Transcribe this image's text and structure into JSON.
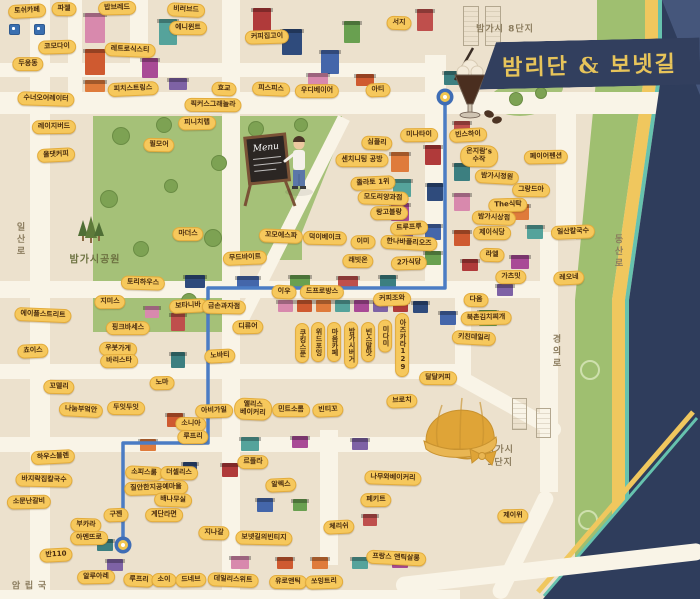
{
  "title": {
    "text": "밤리단 & 보넷길"
  },
  "menu_board": {
    "text": "Menu"
  },
  "colors": {
    "background": "#ece1cd",
    "road": "#f9f4e7",
    "park_green": "#a5c178",
    "label_yellow": "#f6c85c",
    "label_text": "#4a2d10",
    "banner_navy": "#323f5e",
    "title_gold": "#e7c45a",
    "route_blue": "#4b7cc4",
    "strip_green": "#9fbf70",
    "strip_yellow": "#f0c75e",
    "strip_teal": "#66c2ae",
    "corner_navy": "#2f3d5c"
  },
  "route": {
    "points": "445,99 445,288 208,288 208,443 123,443 123,545",
    "markers": [
      [
        445,
        97
      ],
      [
        123,
        545
      ]
    ]
  },
  "road_names": [
    {
      "t": "일산로",
      "x": 20,
      "y": 240,
      "v": 1
    },
    {
      "t": "경의로",
      "x": 556,
      "y": 352,
      "v": 1
    },
    {
      "t": "동산로",
      "x": 618,
      "y": 252,
      "v": 1
    },
    {
      "t": "국립암",
      "x": 28,
      "y": 586,
      "v": 1
    }
  ],
  "area_names": [
    {
      "t": "밤가시 8단지",
      "x": 505,
      "y": 28
    },
    {
      "t": "밤가시공원",
      "x": 95,
      "y": 258,
      "park": 1
    },
    {
      "t": "밤가시\n9단지",
      "x": 500,
      "y": 455
    }
  ],
  "labels": [
    {
      "t": "토쉬카페",
      "x": 27,
      "y": 11
    },
    {
      "t": "파젤",
      "x": 64,
      "y": 9
    },
    {
      "t": "밥브레드",
      "x": 117,
      "y": 8
    },
    {
      "t": "비러브드",
      "x": 186,
      "y": 10
    },
    {
      "t": "에니윈트",
      "x": 188,
      "y": 28
    },
    {
      "t": "코모다이",
      "x": 57,
      "y": 47
    },
    {
      "t": "레트로식스티",
      "x": 130,
      "y": 50
    },
    {
      "t": "두옹동",
      "x": 28,
      "y": 64
    },
    {
      "t": "피치스트링스",
      "x": 133,
      "y": 89
    },
    {
      "t": "수너오어레이터",
      "x": 46,
      "y": 99
    },
    {
      "t": "레이지버드",
      "x": 54,
      "y": 127
    },
    {
      "t": "올댓커피",
      "x": 56,
      "y": 155
    },
    {
      "t": "필모어",
      "x": 159,
      "y": 145
    },
    {
      "t": "피니치랩",
      "x": 197,
      "y": 123
    },
    {
      "t": "효교",
      "x": 224,
      "y": 89
    },
    {
      "t": "픽커스그래놀라",
      "x": 213,
      "y": 105
    },
    {
      "t": "커피집고이",
      "x": 267,
      "y": 37
    },
    {
      "t": "피스피스",
      "x": 271,
      "y": 89
    },
    {
      "t": "우디베이어",
      "x": 317,
      "y": 91
    },
    {
      "t": "아티",
      "x": 378,
      "y": 90
    },
    {
      "t": "서지",
      "x": 399,
      "y": 23
    },
    {
      "t": "미나타이",
      "x": 419,
      "y": 135
    },
    {
      "t": "빈스하이",
      "x": 468,
      "y": 135
    },
    {
      "t": "온지람's\n수작",
      "x": 479,
      "y": 156
    },
    {
      "t": "페이어펜션",
      "x": 546,
      "y": 157
    },
    {
      "t": "밤가시정원",
      "x": 497,
      "y": 177
    },
    {
      "t": "그랑드아",
      "x": 531,
      "y": 190
    },
    {
      "t": "The식탁",
      "x": 508,
      "y": 205
    },
    {
      "t": "밤가시상점",
      "x": 494,
      "y": 218
    },
    {
      "t": "제이식당",
      "x": 492,
      "y": 233
    },
    {
      "t": "일산칼국수",
      "x": 573,
      "y": 232
    },
    {
      "t": "라엘",
      "x": 492,
      "y": 255
    },
    {
      "t": "가츠밋",
      "x": 511,
      "y": 277
    },
    {
      "t": "레오네",
      "x": 569,
      "y": 278
    },
    {
      "t": "다옴",
      "x": 476,
      "y": 300
    },
    {
      "t": "북촌김치찌개",
      "x": 486,
      "y": 318
    },
    {
      "t": "키친데일리",
      "x": 474,
      "y": 338
    },
    {
      "t": "달달커피",
      "x": 438,
      "y": 378
    },
    {
      "t": "브로치",
      "x": 402,
      "y": 401
    },
    {
      "t": "심플리",
      "x": 377,
      "y": 143
    },
    {
      "t": "센치니팅 공방",
      "x": 362,
      "y": 160
    },
    {
      "t": "졸라토 1위",
      "x": 373,
      "y": 183
    },
    {
      "t": "모도리양과점",
      "x": 383,
      "y": 198
    },
    {
      "t": "랑고블랑",
      "x": 389,
      "y": 213
    },
    {
      "t": "트루프루",
      "x": 409,
      "y": 228
    },
    {
      "t": "덕이베이크",
      "x": 325,
      "y": 238
    },
    {
      "t": "이미",
      "x": 363,
      "y": 242
    },
    {
      "t": "한나바플리오즈",
      "x": 409,
      "y": 243
    },
    {
      "t": "래빗온",
      "x": 358,
      "y": 261
    },
    {
      "t": "2가식당",
      "x": 409,
      "y": 263
    },
    {
      "t": "꼬모에스파",
      "x": 281,
      "y": 236
    },
    {
      "t": "마더스",
      "x": 188,
      "y": 234
    },
    {
      "t": "무드바이트",
      "x": 245,
      "y": 258
    },
    {
      "t": "토리하우스",
      "x": 143,
      "y": 283
    },
    {
      "t": "지미스",
      "x": 110,
      "y": 302
    },
    {
      "t": "보타니바",
      "x": 188,
      "y": 306
    },
    {
      "t": "금손과자점",
      "x": 224,
      "y": 307
    },
    {
      "t": "디류어",
      "x": 248,
      "y": 327
    },
    {
      "t": "이우",
      "x": 284,
      "y": 292
    },
    {
      "t": "드프로방스",
      "x": 322,
      "y": 292
    },
    {
      "t": "커피조와",
      "x": 392,
      "y": 299
    },
    {
      "t": "에이플스트리트",
      "x": 43,
      "y": 315
    },
    {
      "t": "핑크바세스",
      "x": 128,
      "y": 328
    },
    {
      "t": "쵸이스",
      "x": 33,
      "y": 351
    },
    {
      "t": "우붓가게",
      "x": 118,
      "y": 349
    },
    {
      "t": "바리스타",
      "x": 119,
      "y": 361
    },
    {
      "t": "노바티",
      "x": 220,
      "y": 356
    },
    {
      "t": "꼬델리",
      "x": 59,
      "y": 387
    },
    {
      "t": "노마",
      "x": 162,
      "y": 383
    },
    {
      "t": "나눔부엌안",
      "x": 81,
      "y": 410
    },
    {
      "t": "두잇두잇",
      "x": 126,
      "y": 408
    },
    {
      "t": "아비가일",
      "x": 214,
      "y": 411
    },
    {
      "t": "앨리스\n베이커리",
      "x": 253,
      "y": 409
    },
    {
      "t": "민트소롬",
      "x": 291,
      "y": 410
    },
    {
      "t": "빈티꼬",
      "x": 328,
      "y": 410
    },
    {
      "t": "소니아",
      "x": 191,
      "y": 424
    },
    {
      "t": "루프리",
      "x": 193,
      "y": 437
    },
    {
      "t": "하우스블렌",
      "x": 53,
      "y": 457
    },
    {
      "t": "바지락집칼국수",
      "x": 44,
      "y": 480
    },
    {
      "t": "소문난갈비",
      "x": 29,
      "y": 502
    },
    {
      "t": "소피스룸",
      "x": 144,
      "y": 473
    },
    {
      "t": "더셀리스",
      "x": 179,
      "y": 473
    },
    {
      "t": "질안한지공예마을",
      "x": 156,
      "y": 488
    },
    {
      "t": "배나무실",
      "x": 173,
      "y": 500
    },
    {
      "t": "계단라면",
      "x": 164,
      "y": 515
    },
    {
      "t": "구젠",
      "x": 116,
      "y": 515
    },
    {
      "t": "부카라",
      "x": 86,
      "y": 525
    },
    {
      "t": "아멘뜨로",
      "x": 89,
      "y": 538
    },
    {
      "t": "반110",
      "x": 56,
      "y": 555
    },
    {
      "t": "지나갈",
      "x": 214,
      "y": 533
    },
    {
      "t": "알루아레",
      "x": 96,
      "y": 577
    },
    {
      "t": "루프리",
      "x": 139,
      "y": 580
    },
    {
      "t": "소이",
      "x": 164,
      "y": 580
    },
    {
      "t": "드네브",
      "x": 191,
      "y": 580
    },
    {
      "t": "데일리스위트",
      "x": 233,
      "y": 580
    },
    {
      "t": "르플라",
      "x": 253,
      "y": 462
    },
    {
      "t": "알렉스",
      "x": 281,
      "y": 485
    },
    {
      "t": "나무와베이커리",
      "x": 393,
      "y": 478
    },
    {
      "t": "페키트",
      "x": 376,
      "y": 500
    },
    {
      "t": "체리쉬",
      "x": 339,
      "y": 527
    },
    {
      "t": "보넷길의빈티지",
      "x": 264,
      "y": 538
    },
    {
      "t": "제이위",
      "x": 513,
      "y": 516
    },
    {
      "t": "프랑스 앤틱살롱",
      "x": 396,
      "y": 558
    },
    {
      "t": "유로앤틱",
      "x": 288,
      "y": 582
    },
    {
      "t": "쏘잉트리",
      "x": 324,
      "y": 582
    },
    {
      "t": "쿠킹스푼",
      "x": 302,
      "y": 343,
      "v": 1
    },
    {
      "t": "위드포잉",
      "x": 318,
      "y": 342,
      "v": 1
    },
    {
      "t": "마음카페",
      "x": 334,
      "y": 342,
      "v": 1
    },
    {
      "t": "밤가시버거",
      "x": 351,
      "y": 345,
      "v": 1
    },
    {
      "t": "빈스말맛",
      "x": 368,
      "y": 342,
      "v": 1
    },
    {
      "t": "미다미",
      "x": 385,
      "y": 336,
      "v": 1
    },
    {
      "t": "아즈카라129",
      "x": 402,
      "y": 345,
      "v": 1
    }
  ]
}
